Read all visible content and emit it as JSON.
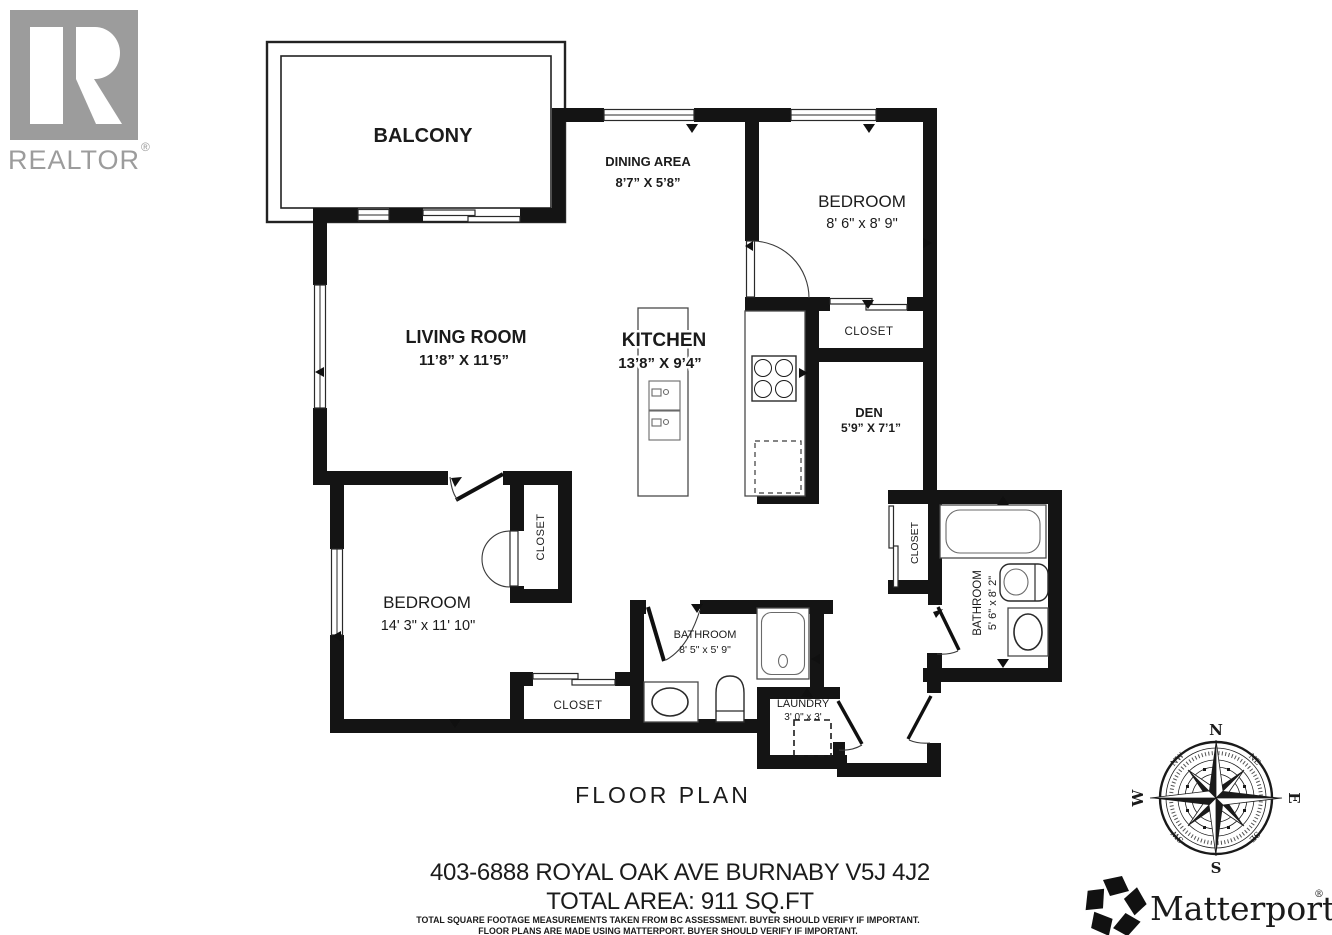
{
  "branding": {
    "realtor": {
      "logo_letter": "R",
      "wordmark": "REALTOR",
      "reg": "®"
    },
    "matterport": {
      "wordmark": "Matterport",
      "reg": "®"
    }
  },
  "footer": {
    "title": "FLOOR PLAN",
    "address": "403-6888 ROYAL OAK AVE BURNABY V5J 4J2",
    "total_area": "TOTAL AREA: 911 SQ.FT",
    "disclaimer1": "TOTAL SQUARE FOOTAGE MEASUREMENTS TAKEN FROM BC ASSESSMENT. BUYER SHOULD VERIFY IF IMPORTANT.",
    "disclaimer2": "FLOOR PLANS ARE MADE USING MATTERPORT. BUYER SHOULD VERIFY IF IMPORTANT."
  },
  "compass": {
    "n": "N",
    "e": "E",
    "s": "S",
    "w": "W",
    "ne": "NE",
    "se": "SE",
    "sw": "SW",
    "nw": "NW"
  },
  "rooms": {
    "balcony": {
      "name": "BALCONY"
    },
    "dining_area": {
      "name": "DINING AREA",
      "dims": "8’7” X 5’8”"
    },
    "bedroom_top": {
      "name": "BEDROOM",
      "dims": "8' 6\" x 8' 9\""
    },
    "closet_bedroom_top": {
      "name": "CLOSET"
    },
    "living_room": {
      "name": "LIVING ROOM",
      "dims": "11’8” X 11’5”"
    },
    "kitchen": {
      "name": "KITCHEN",
      "dims": "13’8” X 9’4”"
    },
    "den": {
      "name": "DEN",
      "dims": "5’9” X 7’1”"
    },
    "bedroom_main": {
      "name": "BEDROOM",
      "dims": "14' 3\" x 11' 10\""
    },
    "closet_bedroom_main": {
      "name": "CLOSET"
    },
    "closet_hall": {
      "name": "CLOSET"
    },
    "bathroom_main": {
      "name": "BATHROOM",
      "dims": "8' 5\" x 5' 9\""
    },
    "laundry": {
      "name": "LAUNDRY",
      "dims": "3' 0\" x 3'"
    },
    "bathroom_ensuite": {
      "name": "BATHROOM",
      "dims": "5' 6\" x 8' 2\""
    },
    "closet_entry": {
      "name": "CLOSET"
    }
  },
  "colors": {
    "wall": "#141414",
    "fixture_line": "#4a4a4a",
    "logo_gray": "#9c9c9c",
    "text": "#1b1b1b"
  }
}
